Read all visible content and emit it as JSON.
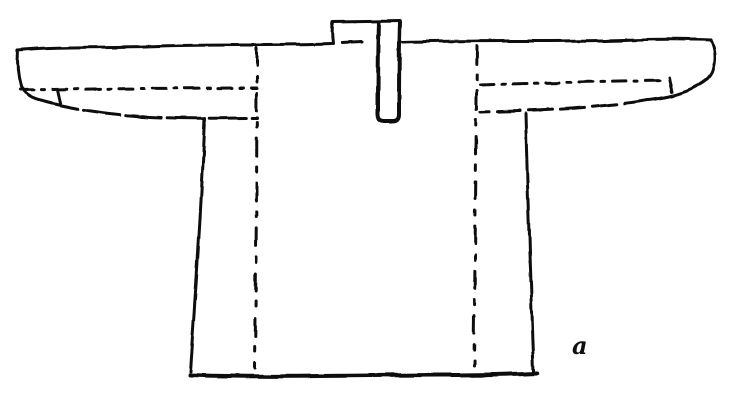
{
  "figure": {
    "label": "a",
    "ink_color": "#101010",
    "background_color": "#ffffff"
  }
}
